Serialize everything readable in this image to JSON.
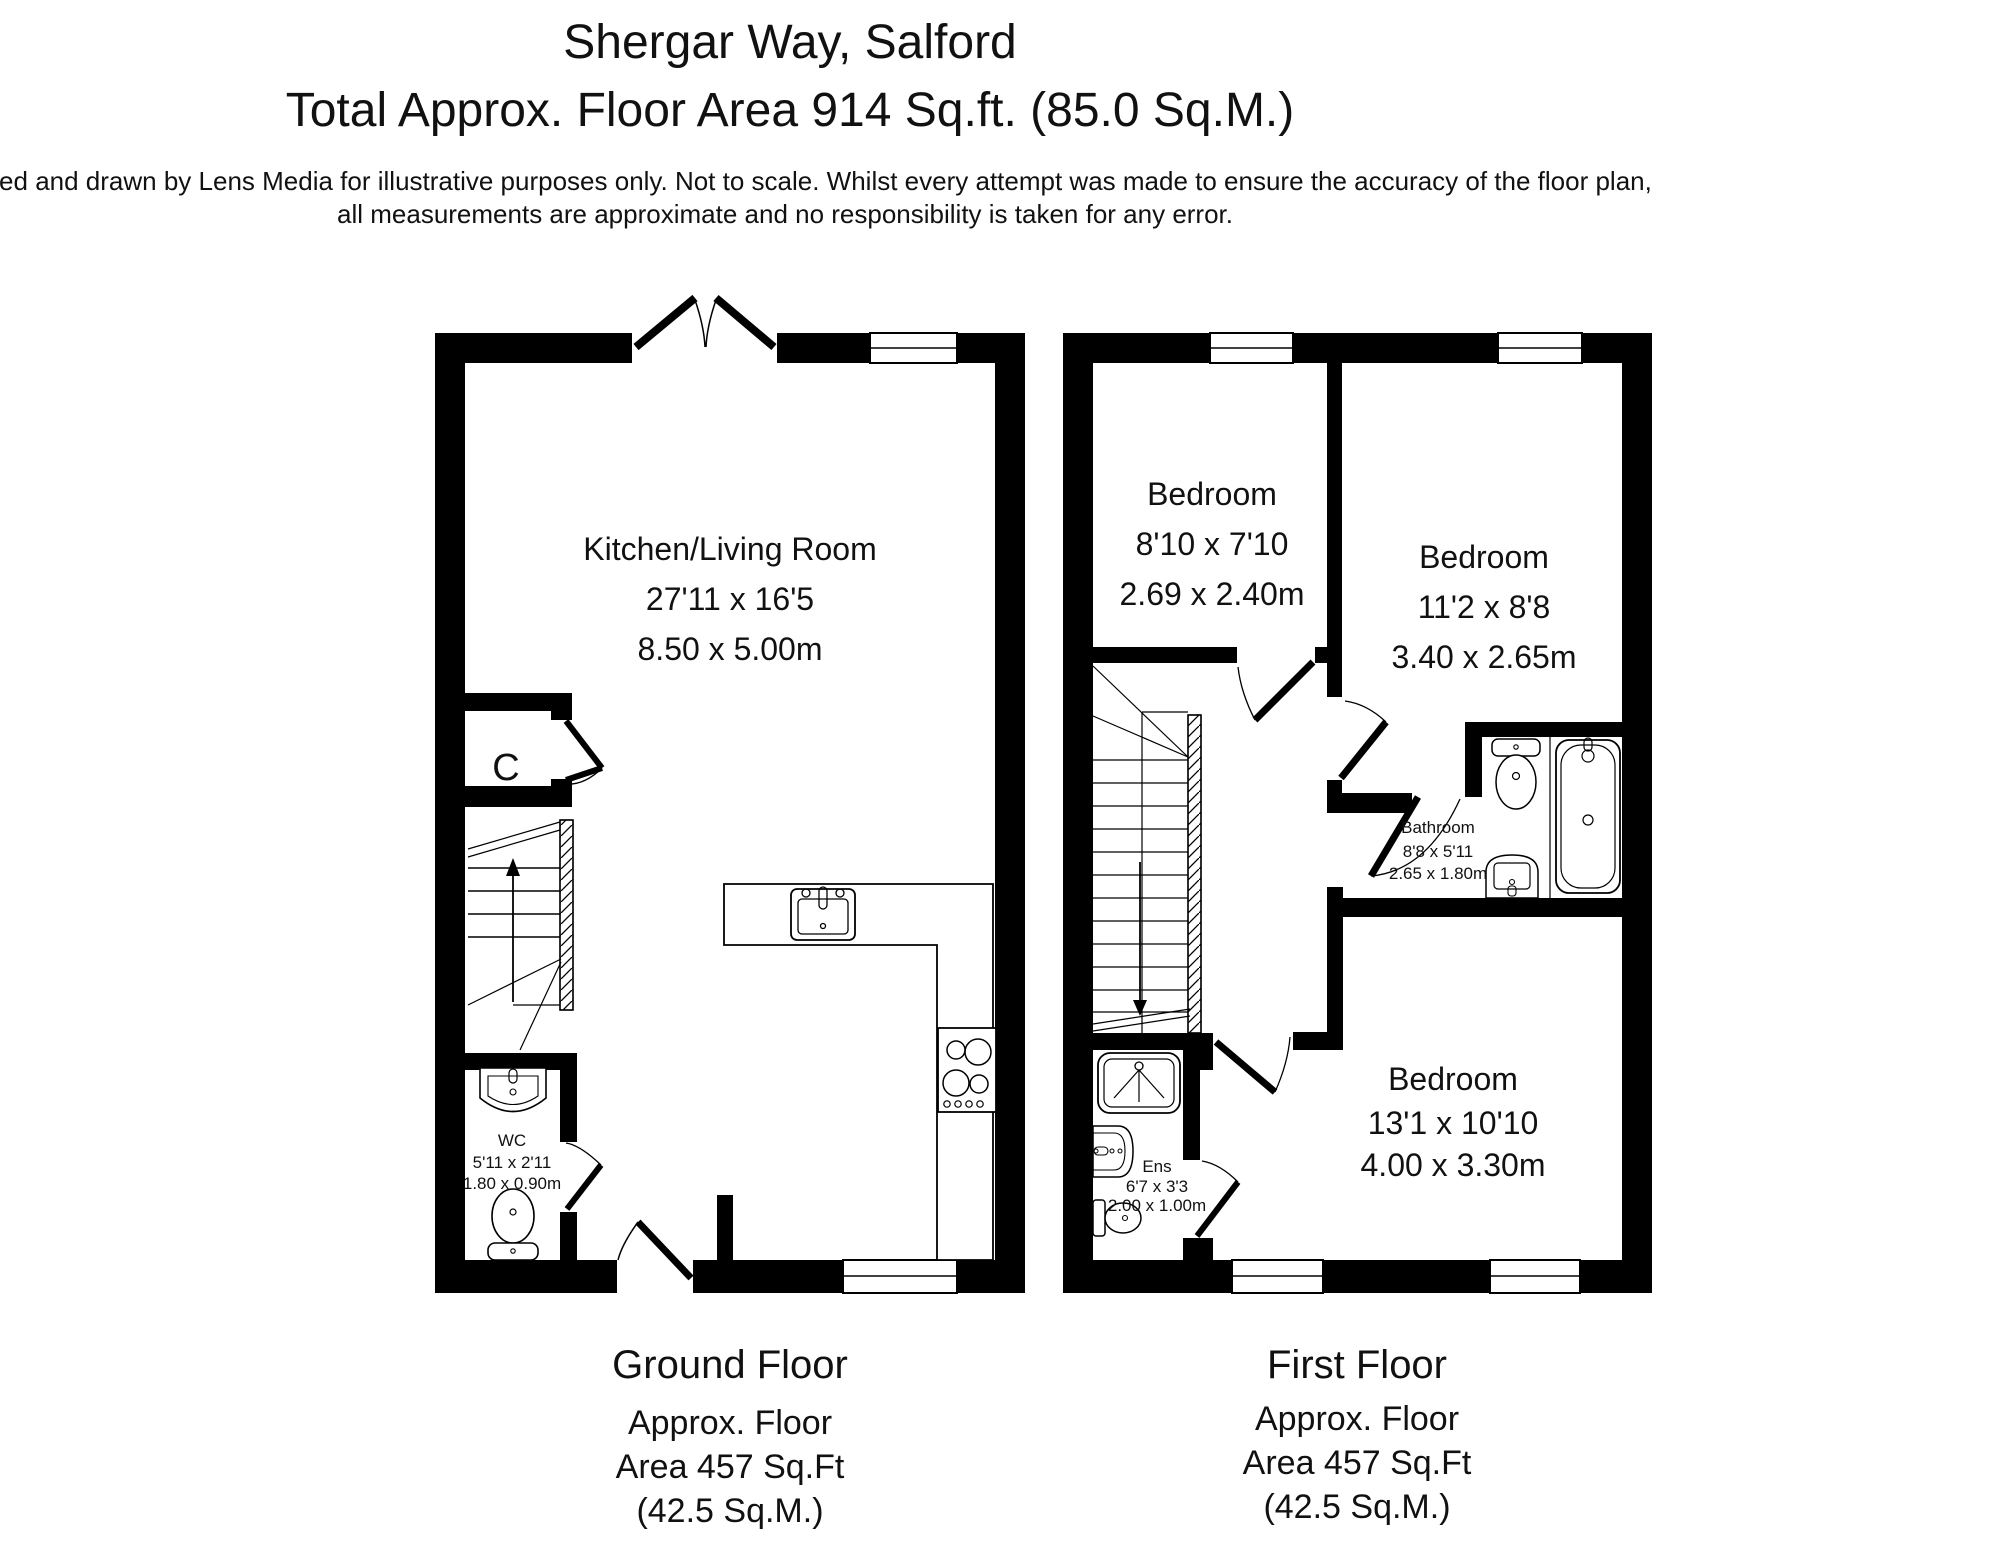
{
  "header": {
    "title": "Shergar Way, Salford",
    "subtitle": "Total Approx. Floor Area 914 Sq.ft. (85.0 Sq.M.)",
    "disclaimer_line1": "Surveyed and drawn by Lens Media for illustrative purposes only. Not to scale. Whilst every attempt was made to ensure the accuracy of the floor plan,",
    "disclaimer_line2": "all measurements are approximate and no responsibility is taken for any error."
  },
  "ground_floor": {
    "label": "Ground Floor",
    "area_line1": "Approx. Floor",
    "area_line2": "Area 457 Sq.Ft",
    "area_line3": "(42.5 Sq.M.)",
    "rooms": {
      "kitchen_living": {
        "name": "Kitchen/Living Room",
        "imperial": "27'11 x 16'5",
        "metric": "8.50 x 5.00m"
      },
      "cupboard": {
        "name": "C"
      },
      "wc": {
        "name": "WC",
        "imperial": "5'11 x 2'11",
        "metric": "1.80 x 0.90m"
      }
    },
    "fixtures": [
      "stairs-up",
      "wash-basin",
      "toilet",
      "kitchen-sink",
      "hob",
      "counter"
    ]
  },
  "first_floor": {
    "label": "First Floor",
    "area_line1": "Approx. Floor",
    "area_line2": "Area 457 Sq.Ft",
    "area_line3": "(42.5 Sq.M.)",
    "rooms": {
      "bedroom1": {
        "name": "Bedroom",
        "imperial": "8'10 x 7'10",
        "metric": "2.69 x 2.40m"
      },
      "bedroom2": {
        "name": "Bedroom",
        "imperial": "11'2 x 8'8",
        "metric": "3.40 x 2.65m"
      },
      "bathroom": {
        "name": "Bathroom",
        "imperial": "8'8 x 5'11",
        "metric": "2.65 x 1.80m"
      },
      "ensuite": {
        "name": "Ens",
        "imperial": "6'7 x 3'3",
        "metric": "2.00 x 1.00m"
      },
      "bedroom3": {
        "name": "Bedroom",
        "imperial": "13'1 x 10'10",
        "metric": "4.00 x 3.30m"
      }
    },
    "fixtures": [
      "stairs-down",
      "toilet",
      "bath",
      "pedestal-basin",
      "shower",
      "wash-basin"
    ]
  },
  "colors": {
    "wall": "#000000",
    "background": "#ffffff",
    "text": "#111111"
  }
}
